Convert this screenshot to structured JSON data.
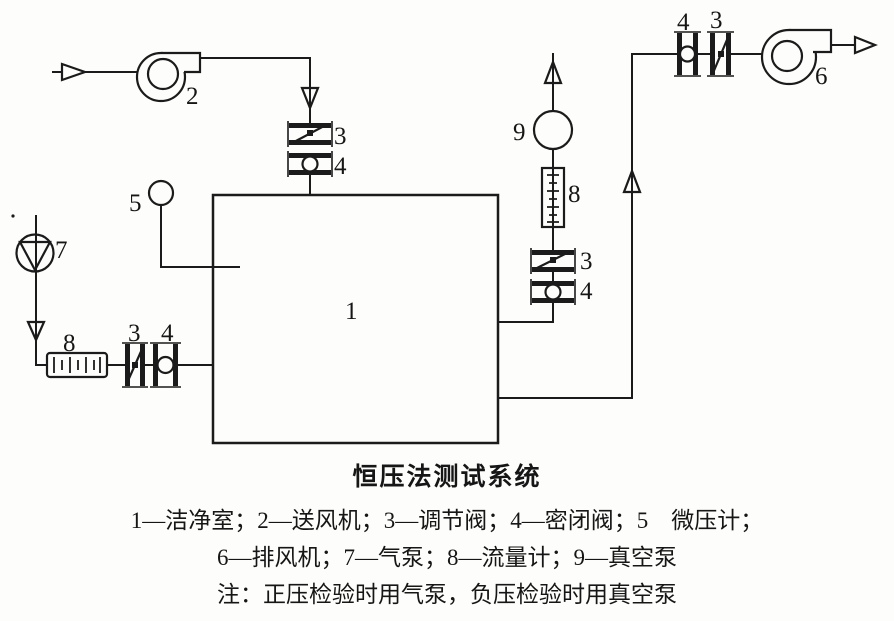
{
  "diagram": {
    "labels": {
      "clean_room": "1",
      "supply_fan": "2",
      "valve_regulating_top": "3",
      "valve_sealed_top": "4",
      "micromanometer": "5",
      "exhaust_fan": "6",
      "air_pump": "7",
      "flowmeter_left": "8",
      "valve_regulating_left": "3",
      "valve_sealed_left": "4",
      "vacuum_pump": "9",
      "flowmeter_right": "8",
      "valve_regulating_right": "3",
      "valve_sealed_right": "4",
      "valve_sealed_topright": "4",
      "valve_regulating_topright": "3"
    }
  },
  "caption": {
    "title": "恒压法测试系统",
    "legend_line1": "1—洁净室；2—送风机；3—调节阀；4—密闭阀；5　微压计；",
    "legend_line2": "6—排风机；7—气泵；8—流量计；9—真空泵",
    "note": "注：正压检验时用气泵，负压检验时用真空泵"
  },
  "colors": {
    "ink": "#1b1b1b",
    "background": "#fdfdfb"
  }
}
